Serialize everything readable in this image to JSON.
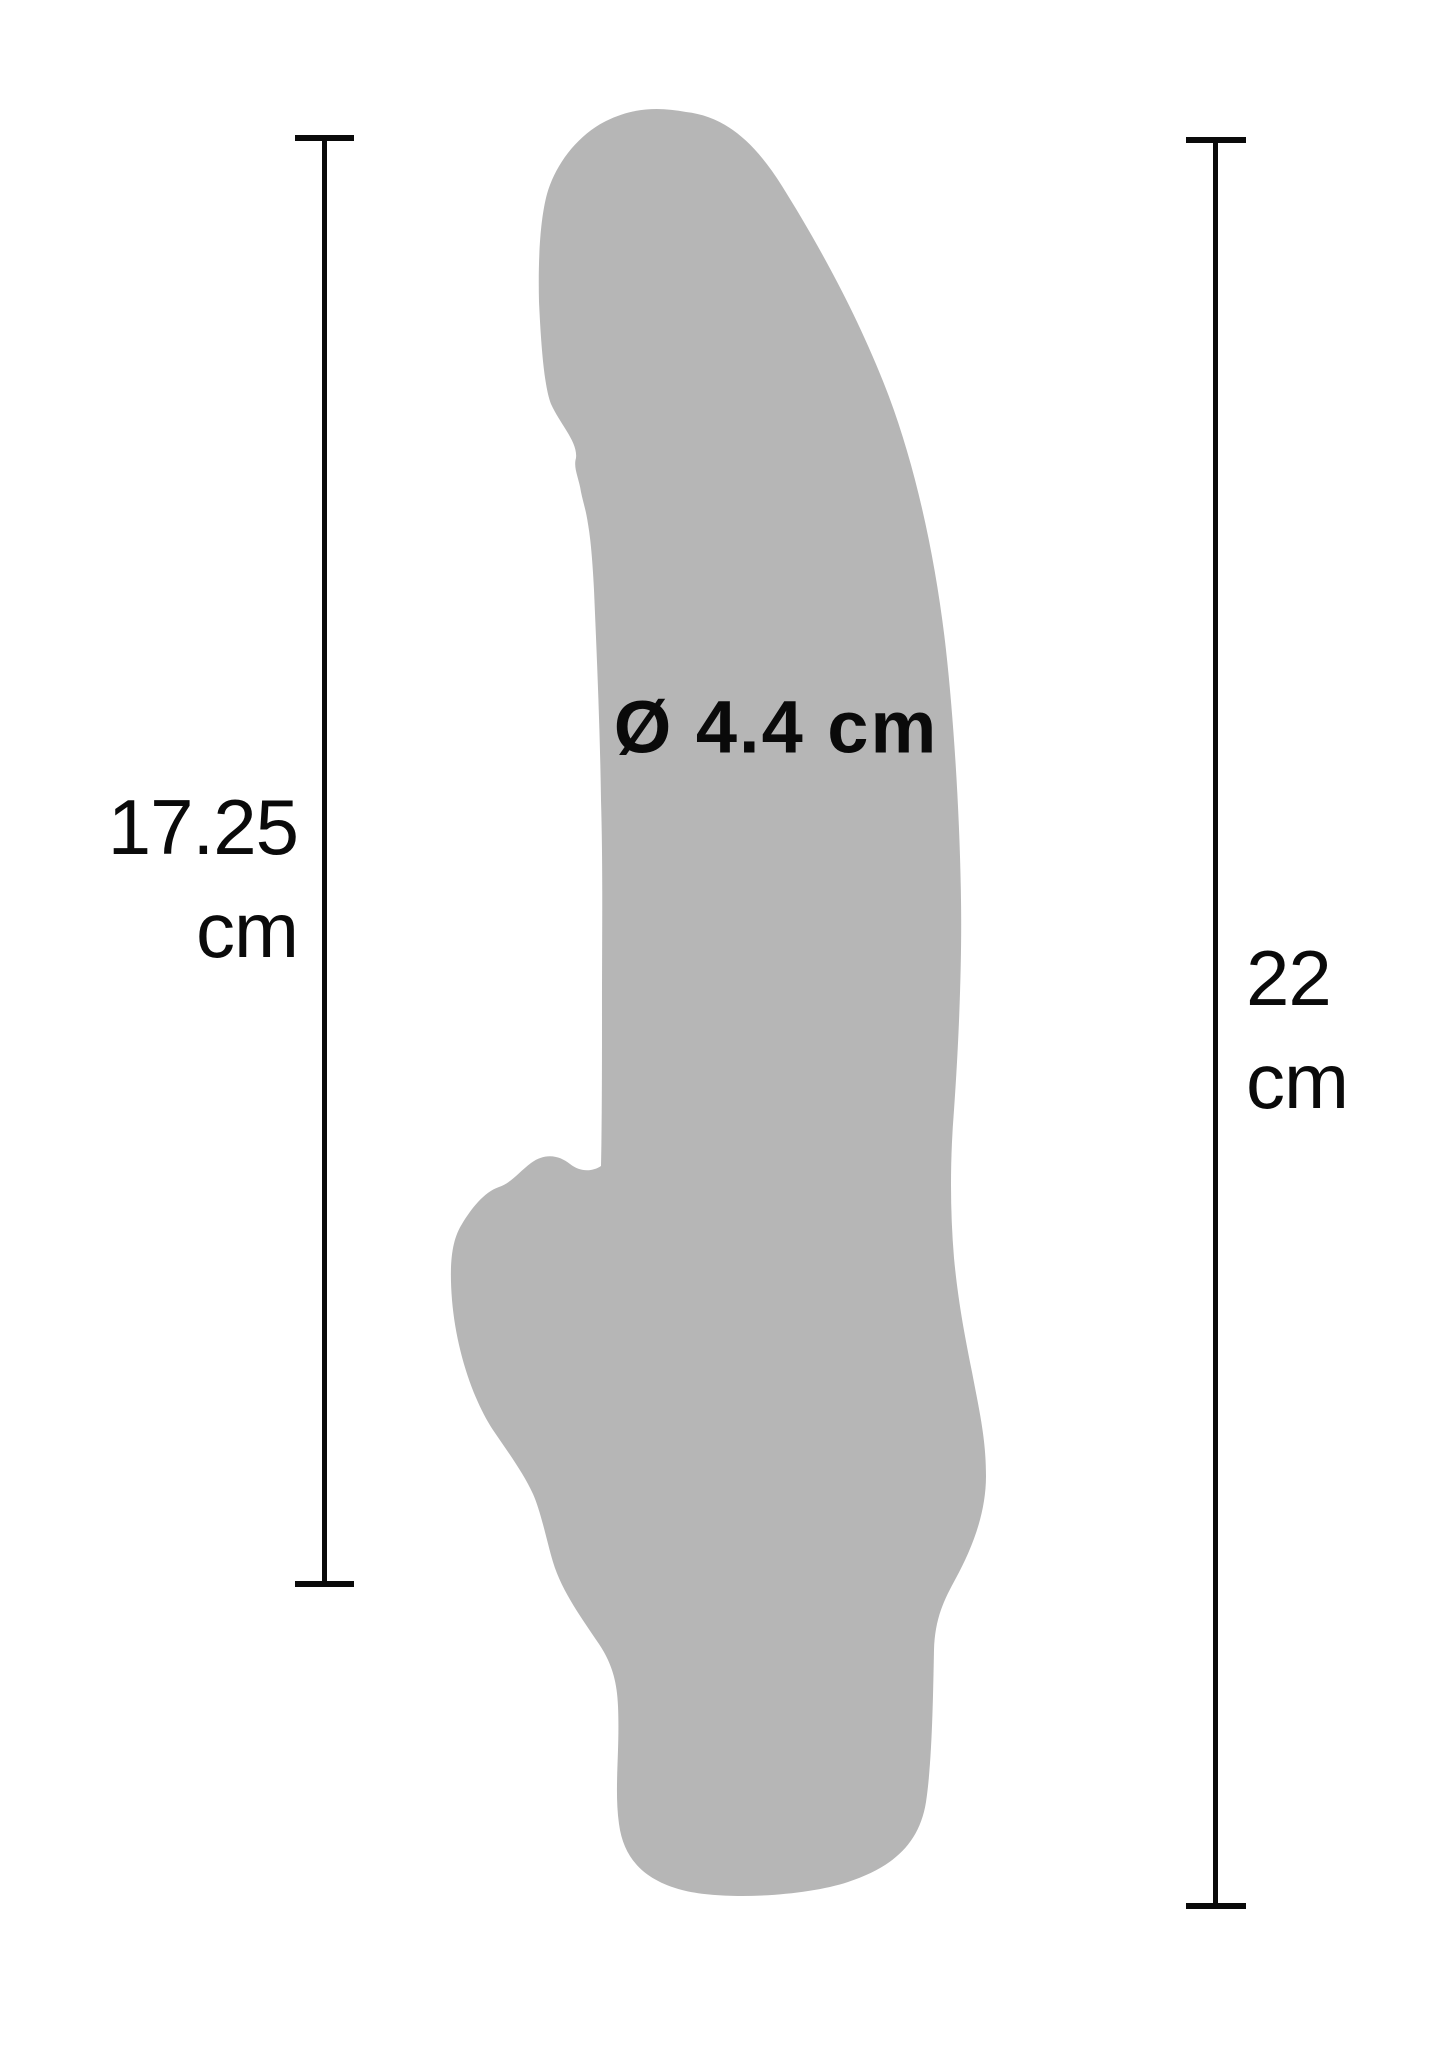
{
  "canvas": {
    "width": 1445,
    "height": 2047,
    "background": "#ffffff"
  },
  "figure": {
    "name": "product-silhouette",
    "color": "#b6b6b6",
    "silhouette_path": "M 686 112 C 722 116 752 138 782 186 C 812 234 856 310 888 394 C 916 468 936 560 946 650 C 954 722 960 820 961 900 C 962 960 959 1040 954 1110 C 950 1160 950 1210 954 1258 C 958 1300 964 1332 972 1372 C 980 1414 986 1440 986 1476 C 986 1516 970 1552 956 1578 C 944 1600 935 1618 934 1650 C 933 1700 932 1762 926 1802 C 919 1846 890 1868 848 1882 C 806 1896 724 1901 682 1890 C 648 1881 624 1862 619 1824 C 614 1788 620 1752 618 1706 C 617 1680 611 1662 599 1644 C 583 1620 562 1592 553 1562 C 547 1542 541 1512 533 1494 C 524 1474 508 1452 493 1430 C 472 1398 456 1348 452 1300 C 449 1262 452 1240 462 1224 C 471 1209 484 1192 499 1187 C 511 1183 519 1172 531 1163 C 546 1152 560 1156 570 1164 C 580 1172 592 1172 601 1166 C 602 1120 602 1060 602 1010 C 602 930 603 870 601 800 C 600 730 597 660 594 590 C 592 552 590 536 588 524 C 586 510 583 502 581 492 C 579 478 573 468 576 458 C 578 442 560 424 551 404 C 544 386 541 344 539 302 C 538 260 540 220 547 194 C 555 166 576 136 606 121 C 634 107 660 107 686 112 Z"
  },
  "annotations": {
    "diameter_label": "Ø 4.4 cm",
    "left_measurement": {
      "value": "17.25",
      "unit": "cm"
    },
    "right_measurement": {
      "value": "22",
      "unit": "cm"
    }
  },
  "colors": {
    "line": "#0a0a0a",
    "text": "#0a0a0a",
    "silhouette": "#b6b6b6",
    "background": "#ffffff"
  }
}
